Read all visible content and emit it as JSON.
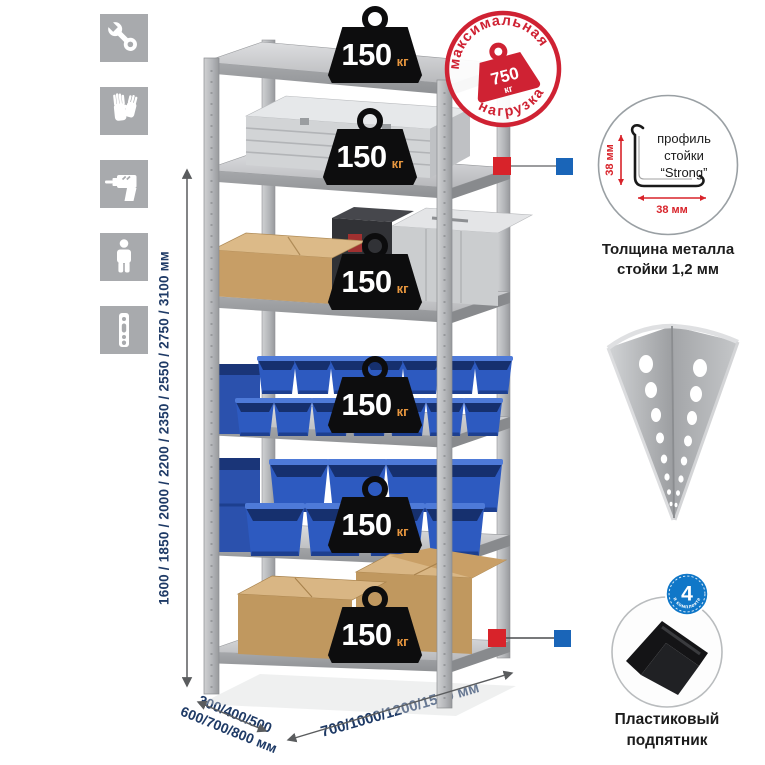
{
  "page": {
    "background": "#ffffff"
  },
  "legend_icons": {
    "tile_color": "#a8aaad",
    "items": [
      {
        "name": "wrench"
      },
      {
        "name": "gloves"
      },
      {
        "name": "drill"
      },
      {
        "name": "person"
      },
      {
        "name": "perforated-strip"
      }
    ]
  },
  "dimensions": {
    "label_color": "#1e3a66",
    "height_options": "1600 / 1850 / 2000 / 2200 / 2350 / 2550 / 2750 / 3100 мм",
    "depth_options": "300/400/500\n600/700/800 мм",
    "width_options": "700/1000/1200/1500 мм"
  },
  "rack": {
    "shelf_load_unit": "кг",
    "shelves": [
      {
        "load": "150"
      },
      {
        "load": "150"
      },
      {
        "load": "150"
      },
      {
        "load": "150"
      },
      {
        "load": "150"
      },
      {
        "load": "150"
      }
    ]
  },
  "max_load_stamp": {
    "arc_top": "максимальная",
    "arc_bottom": "нагрузка",
    "value": "750",
    "unit": "кг",
    "color": "#cf2233"
  },
  "profile_callout": {
    "vertical_dim": "38 мм",
    "horizontal_dim": "38 мм",
    "label_line1": "профиль",
    "label_line2": "стойки",
    "label_line3": "“Strong”",
    "caption": "Толщина металла стойки 1,2 мм",
    "dim_color": "#d8232a"
  },
  "foot_callout": {
    "badge_value": "4",
    "badge_arc": "в комплекте",
    "badge_color": "#1077c8",
    "caption": "Пластиковый подпятник"
  },
  "markers": {
    "red": "#d8232a",
    "blue": "#1a65b8"
  }
}
